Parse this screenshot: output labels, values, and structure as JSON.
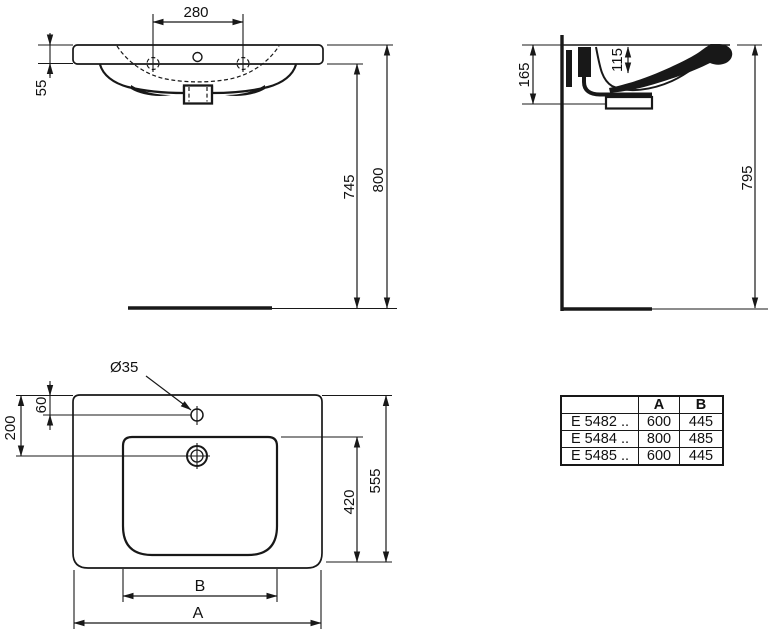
{
  "drawing": {
    "front_view": {
      "tap_spacing": "280",
      "rim_thickness": "55",
      "height_underside": "745",
      "height_rim": "800"
    },
    "side_view": {
      "profile_height": "165",
      "inner_depth": "115",
      "mounting_height": "795"
    },
    "top_view": {
      "tap_hole_diameter": "Ø35",
      "tap_hole_offset": "60",
      "drain_offset": "200",
      "bowl_length": "420",
      "overall_depth": "555",
      "bowl_width_label": "B",
      "overall_width_label": "A"
    }
  },
  "table": {
    "headers": [
      "",
      "A",
      "B"
    ],
    "rows": [
      {
        "model": "E 5482 ..",
        "a": "600",
        "b": "445"
      },
      {
        "model": "E 5484 ..",
        "a": "800",
        "b": "485"
      },
      {
        "model": "E 5485 ..",
        "a": "600",
        "b": "445"
      }
    ]
  },
  "colors": {
    "line": "#181818",
    "background": "#ffffff"
  }
}
